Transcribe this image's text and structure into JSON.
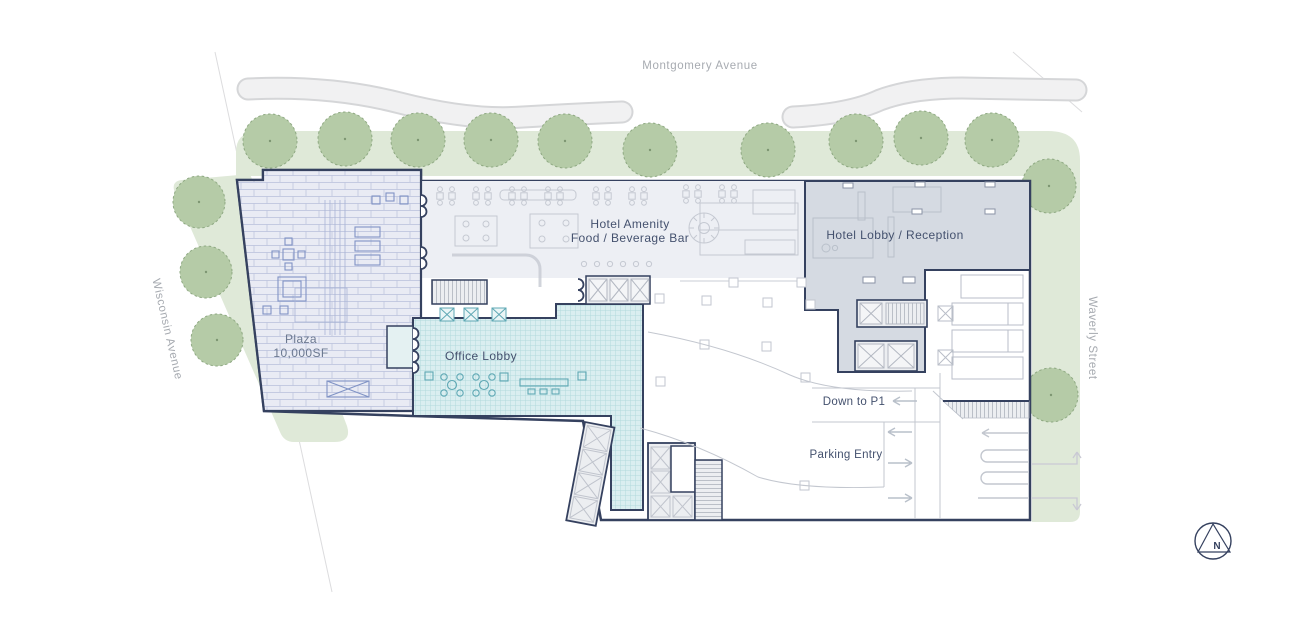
{
  "title": "Ground floor site plan",
  "streets": {
    "top": "Montgomery Avenue",
    "left": "Wisconsin Avenue",
    "right": "Waverly Street"
  },
  "rooms": {
    "plaza": {
      "name": "Plaza",
      "area": "10,000SF"
    },
    "hotel_amenity": {
      "line1": "Hotel Amenity",
      "line2": "Food / Beverage Bar"
    },
    "hotel_lobby": {
      "label": "Hotel Lobby / Reception"
    },
    "office_lobby": {
      "label": "Office Lobby"
    }
  },
  "parking": {
    "down_to_p1": "Down to P1",
    "entry": "Parking Entry"
  },
  "compass": {
    "label": "N"
  },
  "colors": {
    "outline_navy": "#35415f",
    "plaza_fill": "#e9ebf4",
    "plaza_brick_line": "#b8bfdb",
    "plaza_furniture": "#8093c5",
    "amenity_fill": "#edeff4",
    "hotel_lobby_fill": "#d5dae2",
    "office_lobby_fill": "#daeef0",
    "office_lobby_grid": "#b2d9dd",
    "office_furniture_teal": "#5fa8b4",
    "furniture_gray": "#c2c6cf",
    "green_band": "#dfe9d8",
    "tree_fill": "#b5cba7",
    "tree_stroke": "#8fa983",
    "road_fill": "#f1f1f2",
    "road_edge": "#d5d6d8",
    "street_label_gray": "#a7abb1",
    "room_label_navy": "#44516e"
  }
}
